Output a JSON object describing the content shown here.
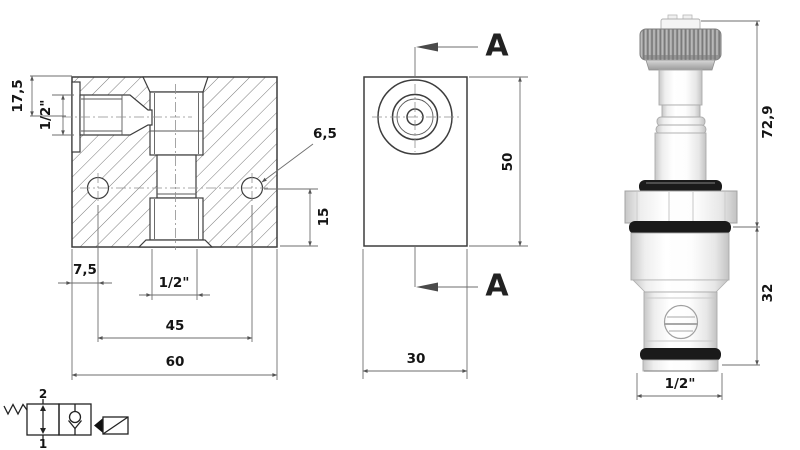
{
  "drawing": {
    "front": {
      "d_top": "17,5",
      "d_port": "1/2\"",
      "d_edge": "7,5",
      "d_bottom_port": "1/2\"",
      "d_holes": "45",
      "d_width": "60",
      "d_hole_h": "15",
      "d_hole_dia": "6,5"
    },
    "side": {
      "a_top": "A",
      "a_bottom": "A",
      "d_height": "50",
      "d_depth": "30"
    },
    "valve": {
      "d_len_upper": "72,9",
      "d_len_cartridge": "32",
      "d_thread": "1/2\""
    },
    "symbol": {
      "port_top": "2",
      "port_bottom": "1"
    }
  },
  "colors": {
    "outline": "#3d3d3d",
    "dimension": "#6e6e6e",
    "text": "#141414",
    "knurl_gray": "#9d9d9d",
    "o_ring_black": "#1a1a1a"
  }
}
